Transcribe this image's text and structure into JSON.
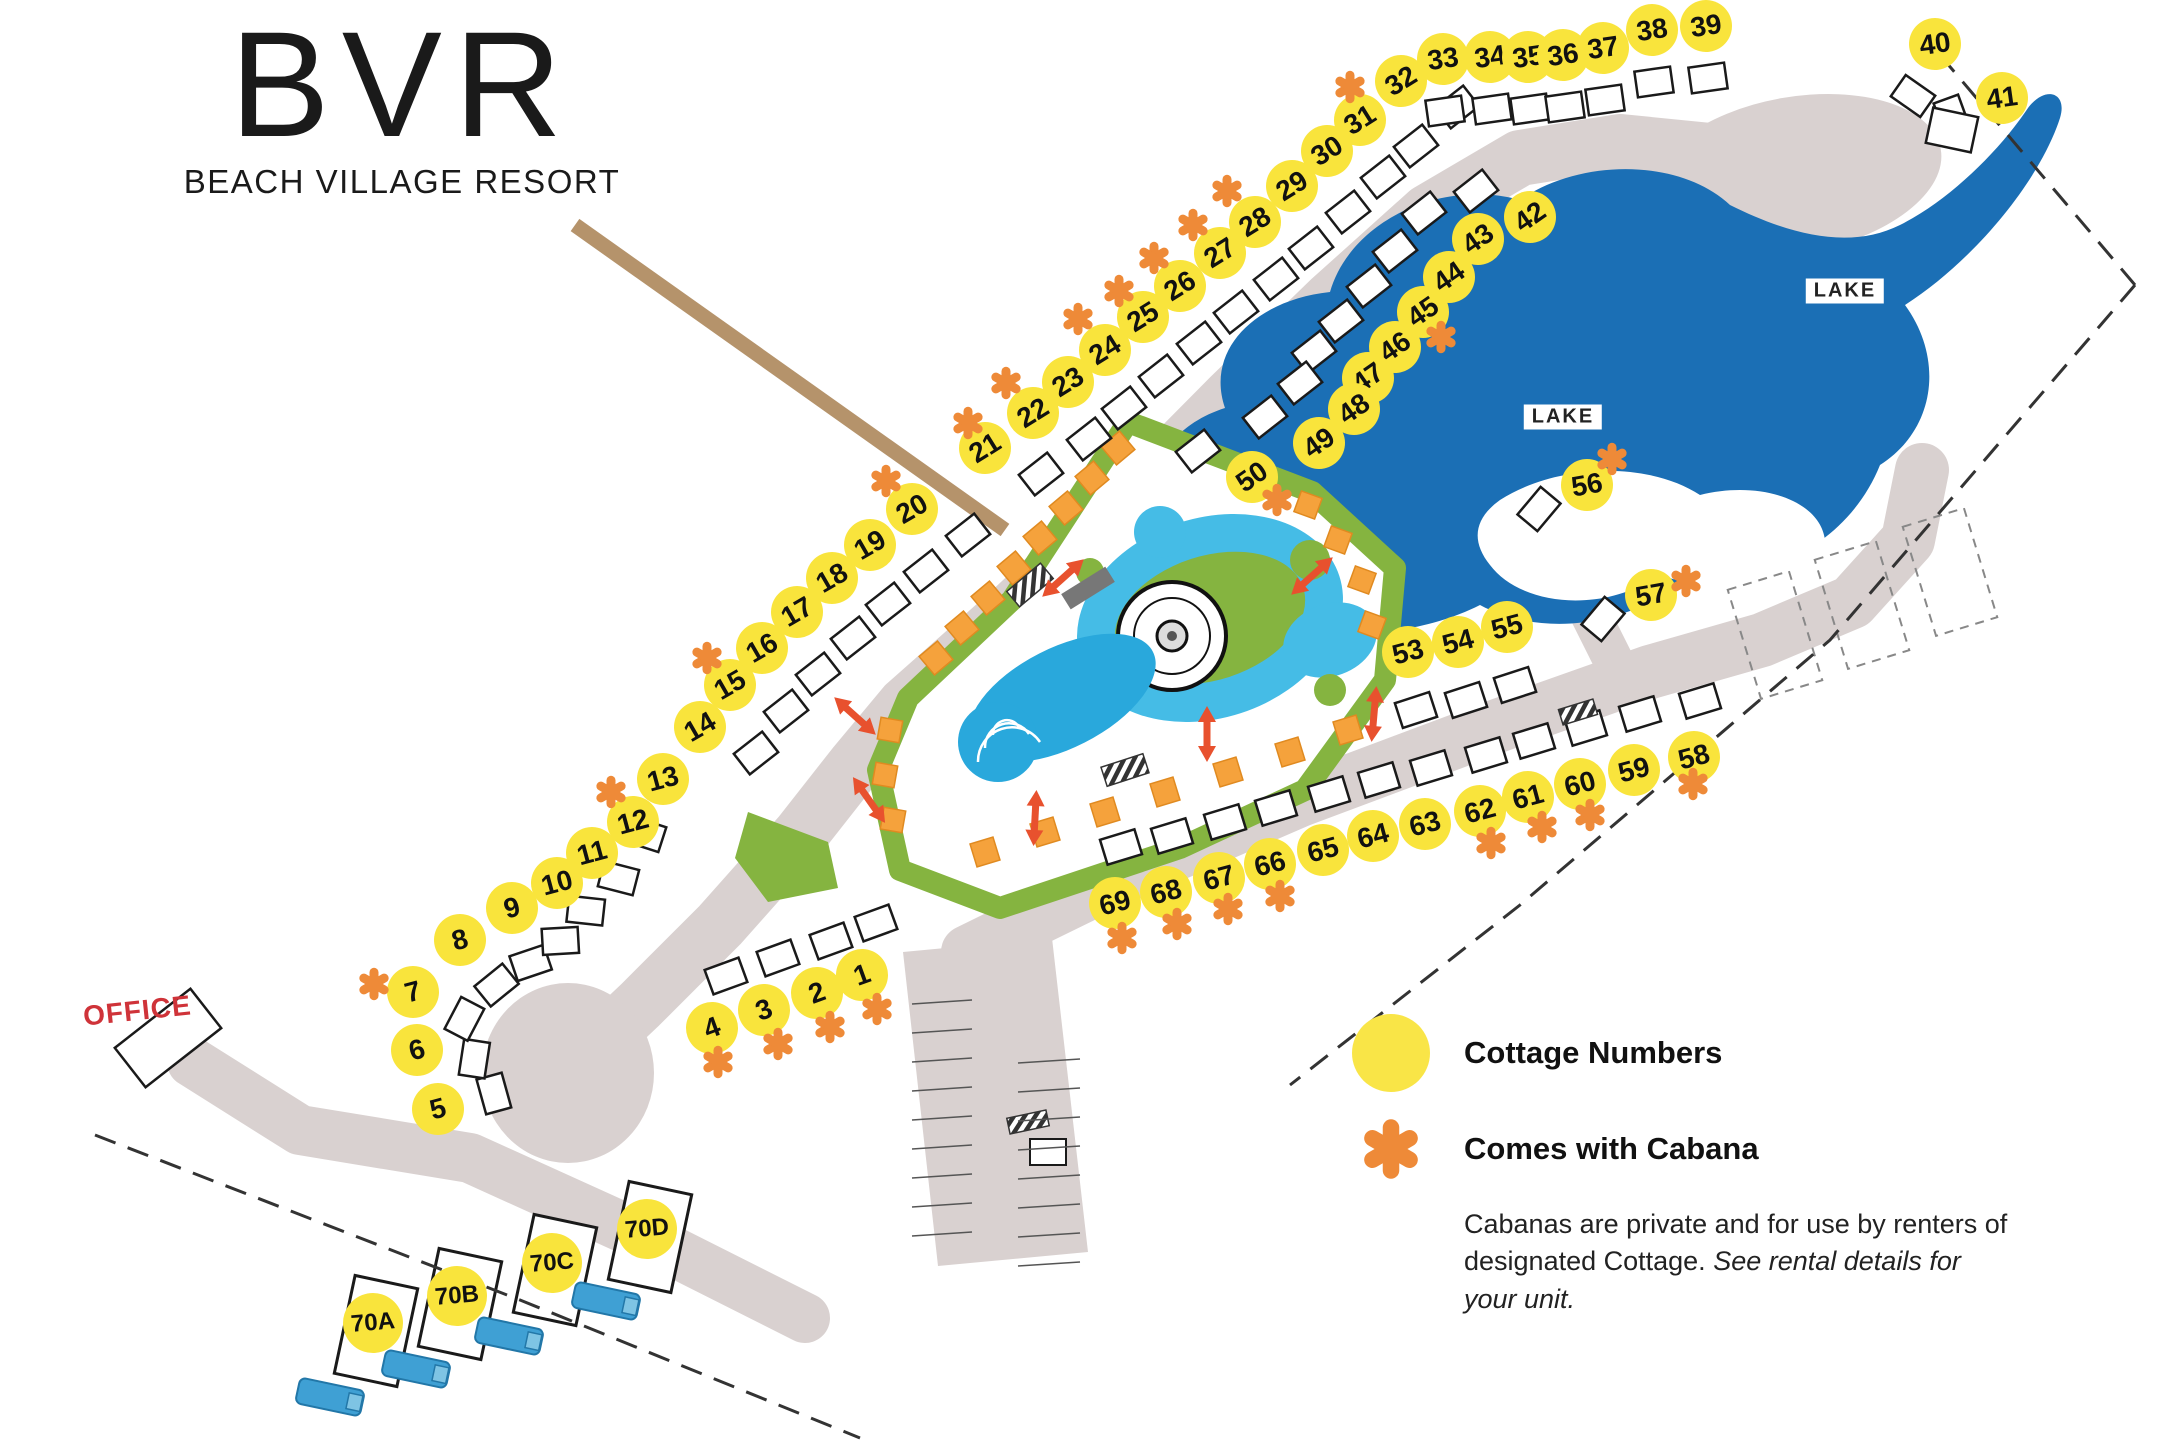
{
  "logo": {
    "abbr": "BVR",
    "name": "BEACH VILLAGE RESORT"
  },
  "office": {
    "label": "OFFICE"
  },
  "lake_labels": [
    {
      "text": "LAKE",
      "x": 1563,
      "y": 417
    },
    {
      "text": "LAKE",
      "x": 1845,
      "y": 291
    }
  ],
  "legend": {
    "cottage_label": "Cottage Numbers",
    "cabana_label": "Comes with Cabana",
    "note_plain": "Cabanas are private and for use by renters of designated Cottage. ",
    "note_italic": "See rental details for your unit."
  },
  "colors": {
    "cottage_yellow": "#f9e43c",
    "cabana_orange": "#ee8a38",
    "road": "#d9d1d0",
    "lake": "#1b6fb5",
    "pool": "#29a8dc",
    "lazy_river": "#45bce6",
    "green": "#85b440",
    "rv_blue": "#3fa0d4",
    "office_red": "#cf3339",
    "arrow_red": "#e8512e",
    "boardwalk_tan": "#b5936b"
  },
  "cottages": [
    {
      "n": "1",
      "g": "A",
      "x": 862,
      "y": 975,
      "c": true,
      "ax": 877,
      "ay": 1009
    },
    {
      "n": "2",
      "g": "A",
      "x": 817,
      "y": 993,
      "c": true,
      "ax": 830,
      "ay": 1027
    },
    {
      "n": "3",
      "g": "A",
      "x": 764,
      "y": 1010,
      "c": true,
      "ax": 778,
      "ay": 1044
    },
    {
      "n": "4",
      "g": "A",
      "x": 712,
      "y": 1028,
      "c": true,
      "ax": 718,
      "ay": 1062
    },
    {
      "n": "5",
      "g": "B",
      "x": 438,
      "y": 1109,
      "c": false
    },
    {
      "n": "6",
      "g": "B",
      "x": 417,
      "y": 1050,
      "c": false
    },
    {
      "n": "7",
      "g": "B",
      "x": 413,
      "y": 992,
      "c": true,
      "ax": 374,
      "ay": 984
    },
    {
      "n": "8",
      "g": "B",
      "x": 460,
      "y": 940,
      "c": false
    },
    {
      "n": "9",
      "g": "B",
      "x": 512,
      "y": 908,
      "c": false
    },
    {
      "n": "10",
      "g": "B",
      "x": 557,
      "y": 883,
      "c": false
    },
    {
      "n": "11",
      "g": "B",
      "x": 592,
      "y": 853,
      "c": false
    },
    {
      "n": "12",
      "g": "B",
      "x": 633,
      "y": 822,
      "c": true,
      "ax": 611,
      "ay": 792
    },
    {
      "n": "13",
      "g": "B",
      "x": 663,
      "y": 779,
      "c": false
    },
    {
      "n": "14",
      "g": "C",
      "x": 700,
      "y": 727,
      "c": false
    },
    {
      "n": "15",
      "g": "C",
      "x": 730,
      "y": 685,
      "c": true,
      "ax": 707,
      "ay": 658
    },
    {
      "n": "16",
      "g": "C",
      "x": 762,
      "y": 648,
      "c": false
    },
    {
      "n": "17",
      "g": "C",
      "x": 797,
      "y": 612,
      "c": false
    },
    {
      "n": "18",
      "g": "C",
      "x": 832,
      "y": 578,
      "c": false
    },
    {
      "n": "19",
      "g": "C",
      "x": 870,
      "y": 545,
      "c": false
    },
    {
      "n": "20",
      "g": "C",
      "x": 912,
      "y": 509,
      "c": true,
      "ax": 886,
      "ay": 481
    },
    {
      "n": "21",
      "g": "D",
      "x": 985,
      "y": 448,
      "c": true,
      "ax": 968,
      "ay": 423
    },
    {
      "n": "22",
      "g": "D",
      "x": 1033,
      "y": 413,
      "c": true,
      "ax": 1006,
      "ay": 383
    },
    {
      "n": "23",
      "g": "D",
      "x": 1068,
      "y": 382,
      "c": false
    },
    {
      "n": "24",
      "g": "D",
      "x": 1105,
      "y": 350,
      "c": true,
      "ax": 1078,
      "ay": 319
    },
    {
      "n": "25",
      "g": "D",
      "x": 1143,
      "y": 317,
      "c": true,
      "ax": 1119,
      "ay": 291
    },
    {
      "n": "26",
      "g": "D",
      "x": 1180,
      "y": 286,
      "c": true,
      "ax": 1154,
      "ay": 258
    },
    {
      "n": "27",
      "g": "D",
      "x": 1220,
      "y": 253,
      "c": true,
      "ax": 1193,
      "ay": 225
    },
    {
      "n": "28",
      "g": "D",
      "x": 1255,
      "y": 222,
      "c": true,
      "ax": 1227,
      "ay": 191
    },
    {
      "n": "29",
      "g": "D",
      "x": 1292,
      "y": 186,
      "c": false
    },
    {
      "n": "30",
      "g": "D",
      "x": 1327,
      "y": 151,
      "c": false
    },
    {
      "n": "31",
      "g": "D",
      "x": 1360,
      "y": 120,
      "c": false
    },
    {
      "n": "32",
      "g": "D",
      "x": 1401,
      "y": 81,
      "c": true,
      "ax": 1350,
      "ay": 87
    },
    {
      "n": "33",
      "g": "E",
      "x": 1443,
      "y": 59,
      "c": false
    },
    {
      "n": "34",
      "g": "E",
      "x": 1490,
      "y": 57,
      "c": false
    },
    {
      "n": "35",
      "g": "E",
      "x": 1528,
      "y": 57,
      "c": false
    },
    {
      "n": "36",
      "g": "E",
      "x": 1563,
      "y": 55,
      "c": false
    },
    {
      "n": "37",
      "g": "E",
      "x": 1603,
      "y": 48,
      "c": false
    },
    {
      "n": "38",
      "g": "E",
      "x": 1652,
      "y": 30,
      "c": false
    },
    {
      "n": "39",
      "g": "E",
      "x": 1706,
      "y": 26,
      "c": false
    },
    {
      "n": "40",
      "g": "E",
      "x": 1935,
      "y": 44,
      "c": false,
      "b": [
        -22,
        52,
        35
      ]
    },
    {
      "n": "41",
      "g": "E",
      "x": 2002,
      "y": 98,
      "c": false,
      "b": [
        -50,
        18,
        70
      ]
    },
    {
      "n": "42",
      "g": "F",
      "x": 1530,
      "y": 217,
      "c": false
    },
    {
      "n": "43",
      "g": "F",
      "x": 1478,
      "y": 239,
      "c": false
    },
    {
      "n": "44",
      "g": "F",
      "x": 1449,
      "y": 277,
      "c": false
    },
    {
      "n": "45",
      "g": "F",
      "x": 1423,
      "y": 312,
      "c": true,
      "ax": 1441,
      "ay": 337
    },
    {
      "n": "46",
      "g": "F",
      "x": 1395,
      "y": 347,
      "c": false
    },
    {
      "n": "47",
      "g": "F",
      "x": 1368,
      "y": 378,
      "c": false
    },
    {
      "n": "48",
      "g": "F",
      "x": 1354,
      "y": 409,
      "c": false
    },
    {
      "n": "49",
      "g": "F",
      "x": 1319,
      "y": 443,
      "c": false
    },
    {
      "n": "50",
      "g": "F",
      "x": 1252,
      "y": 477,
      "c": true,
      "ax": 1277,
      "ay": 500
    },
    {
      "n": "53",
      "g": "G",
      "x": 1408,
      "y": 652,
      "c": false
    },
    {
      "n": "54",
      "g": "G",
      "x": 1458,
      "y": 642,
      "c": false
    },
    {
      "n": "55",
      "g": "G",
      "x": 1507,
      "y": 627,
      "c": false
    },
    {
      "n": "56",
      "g": "H",
      "x": 1587,
      "y": 485,
      "c": true,
      "ax": 1612,
      "ay": 459
    },
    {
      "n": "57",
      "g": "H",
      "x": 1651,
      "y": 595,
      "c": true,
      "ax": 1686,
      "ay": 581
    },
    {
      "n": "58",
      "g": "I",
      "x": 1694,
      "y": 757,
      "c": true,
      "ax": 1693,
      "ay": 784
    },
    {
      "n": "59",
      "g": "I",
      "x": 1634,
      "y": 770,
      "c": false
    },
    {
      "n": "60",
      "g": "I",
      "x": 1580,
      "y": 784,
      "c": true,
      "ax": 1590,
      "ay": 815
    },
    {
      "n": "61",
      "g": "I",
      "x": 1528,
      "y": 797,
      "c": true,
      "ax": 1542,
      "ay": 827
    },
    {
      "n": "62",
      "g": "I",
      "x": 1480,
      "y": 811,
      "c": true,
      "ax": 1491,
      "ay": 843
    },
    {
      "n": "63",
      "g": "I",
      "x": 1425,
      "y": 824,
      "c": false
    },
    {
      "n": "64",
      "g": "I",
      "x": 1373,
      "y": 836,
      "c": false
    },
    {
      "n": "65",
      "g": "I",
      "x": 1323,
      "y": 850,
      "c": false
    },
    {
      "n": "66",
      "g": "I",
      "x": 1270,
      "y": 864,
      "c": true,
      "ax": 1280,
      "ay": 896
    },
    {
      "n": "67",
      "g": "I",
      "x": 1219,
      "y": 878,
      "c": true,
      "ax": 1228,
      "ay": 909
    },
    {
      "n": "68",
      "g": "I",
      "x": 1166,
      "y": 892,
      "c": true,
      "ax": 1177,
      "ay": 924
    },
    {
      "n": "69",
      "g": "I",
      "x": 1115,
      "y": 903,
      "c": true,
      "ax": 1122,
      "ay": 938
    },
    {
      "n": "70A",
      "g": "J",
      "x": 373,
      "y": 1323,
      "c": false
    },
    {
      "n": "70B",
      "g": "J",
      "x": 457,
      "y": 1296,
      "c": false
    },
    {
      "n": "70C",
      "g": "J",
      "x": 552,
      "y": 1263,
      "c": false
    },
    {
      "n": "70D",
      "g": "J",
      "x": 647,
      "y": 1229,
      "c": false
    }
  ],
  "rvs": [
    {
      "x": 330,
      "y": 1397
    },
    {
      "x": 416,
      "y": 1369
    },
    {
      "x": 509,
      "y": 1336
    },
    {
      "x": 606,
      "y": 1301
    }
  ]
}
